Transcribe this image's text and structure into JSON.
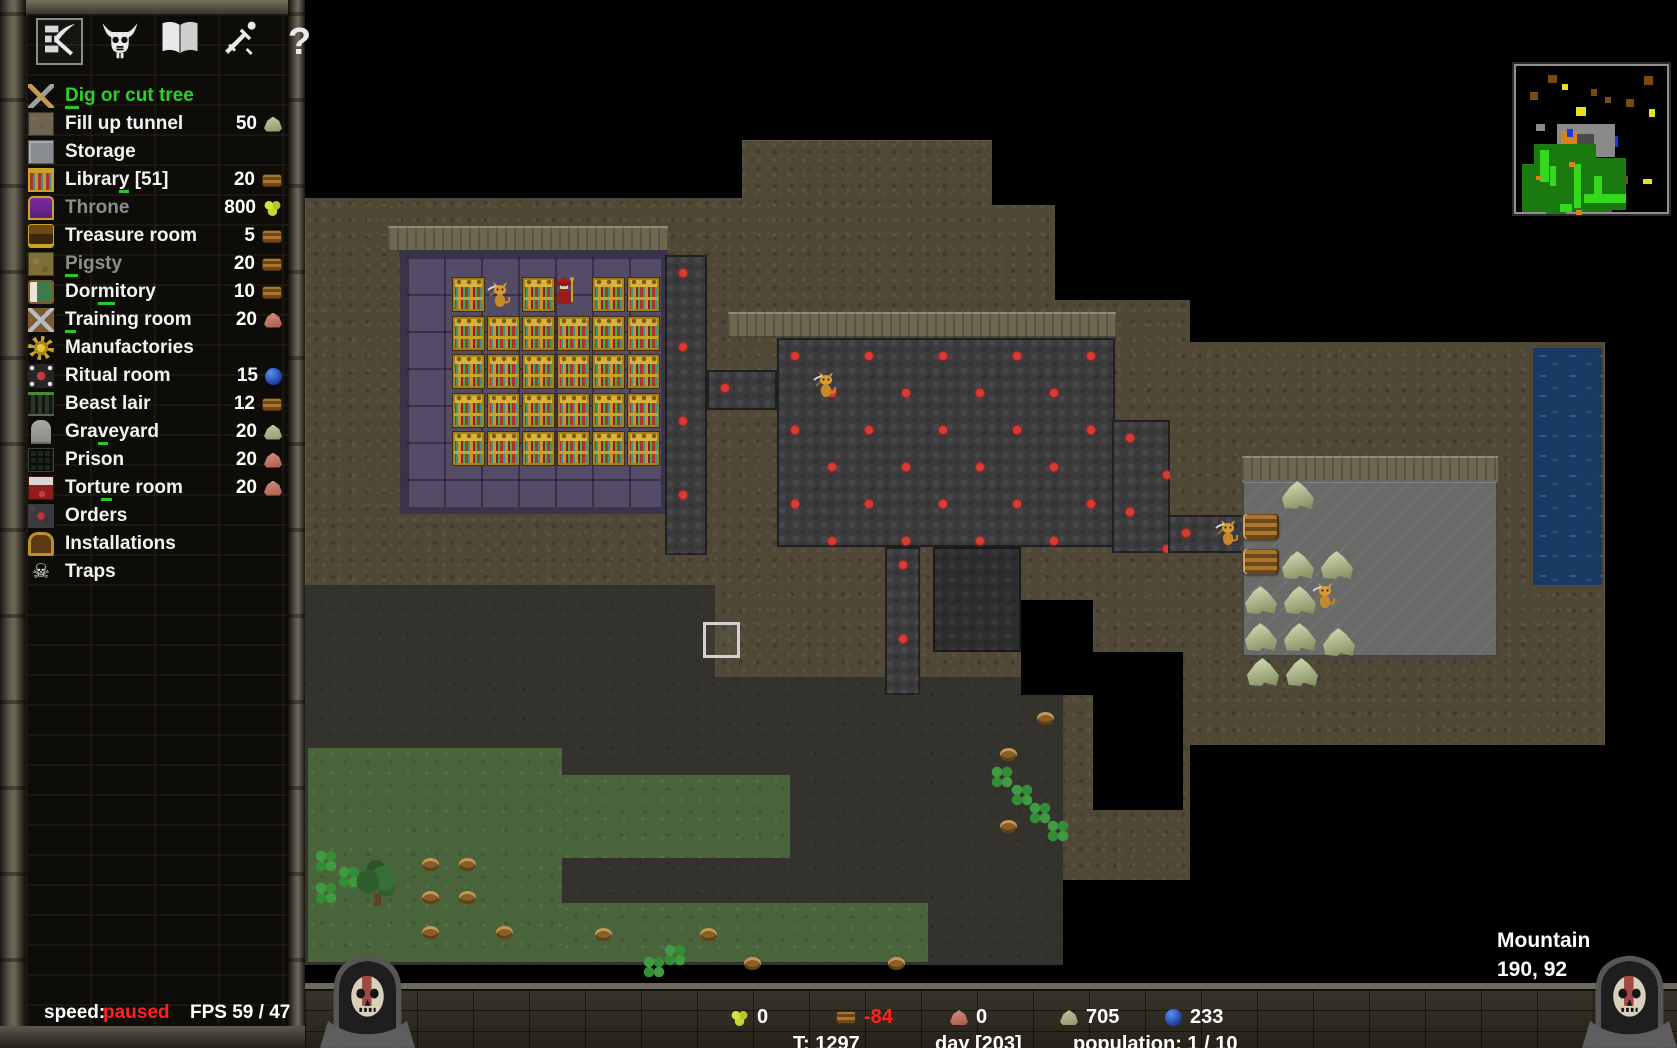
{
  "accent_colors": {
    "selected_green": "#2bd12b",
    "shortcut_green": "#28c828",
    "negative_red": "#ff2020",
    "text_white": "#ffffff",
    "disabled_grey": "#8d8d8d"
  },
  "sidebar": {
    "toolbar": [
      {
        "id": "build",
        "icon": "pickaxe-wall-icon",
        "selected": true
      },
      {
        "id": "minions",
        "icon": "demon-skull-icon",
        "selected": false
      },
      {
        "id": "library",
        "icon": "open-book-icon",
        "selected": false
      },
      {
        "id": "military",
        "icon": "sword-icon",
        "selected": false
      },
      {
        "id": "help",
        "icon": "question-mark-icon",
        "selected": false,
        "glyph": "?"
      }
    ],
    "menu": [
      {
        "label": "Dig or cut tree",
        "shortcut_index": 0,
        "icon": "dig",
        "state": "selected"
      },
      {
        "label": "Fill up tunnel",
        "icon": "fill",
        "state": "normal",
        "cost": "50",
        "cost_resource": "stone"
      },
      {
        "label": "Storage",
        "icon": "storage",
        "state": "normal"
      },
      {
        "label": "Library [51]",
        "shortcut_index": 6,
        "icon": "library",
        "state": "normal",
        "cost": "20",
        "cost_resource": "wood"
      },
      {
        "label": "Throne",
        "icon": "throne",
        "state": "disabled",
        "cost": "800",
        "cost_resource": "gold"
      },
      {
        "label": "Treasure room",
        "icon": "treasure",
        "state": "normal",
        "cost": "5",
        "cost_resource": "wood"
      },
      {
        "label": "Pigsty",
        "shortcut_index": 0,
        "icon": "pigsty",
        "state": "disabled",
        "cost": "20",
        "cost_resource": "wood"
      },
      {
        "label": "Dormitory",
        "shortcut_index": 3,
        "icon": "dormitory",
        "state": "normal",
        "cost": "10",
        "cost_resource": "wood"
      },
      {
        "label": "Training room",
        "shortcut_index": 0,
        "icon": "training",
        "state": "normal",
        "cost": "20",
        "cost_resource": "iron"
      },
      {
        "label": "Manufactories",
        "icon": "manufactory",
        "state": "normal"
      },
      {
        "label": "Ritual room",
        "icon": "ritual",
        "state": "normal",
        "cost": "15",
        "cost_resource": "mana"
      },
      {
        "label": "Beast lair",
        "icon": "beast",
        "state": "normal",
        "cost": "12",
        "cost_resource": "wood"
      },
      {
        "label": "Graveyard",
        "shortcut_index": 3,
        "icon": "graveyard",
        "state": "normal",
        "cost": "20",
        "cost_resource": "stone"
      },
      {
        "label": "Prison",
        "icon": "prison",
        "state": "normal",
        "cost": "20",
        "cost_resource": "iron"
      },
      {
        "label": "Torture room",
        "shortcut_index": 4,
        "icon": "torture",
        "state": "normal",
        "cost": "20",
        "cost_resource": "iron"
      },
      {
        "label": "Orders",
        "icon": "orders",
        "state": "normal"
      },
      {
        "label": "Installations",
        "icon": "installations",
        "state": "normal"
      },
      {
        "label": "Traps",
        "icon": "traps",
        "state": "normal",
        "icon_glyph": "☠"
      }
    ],
    "speed_label": "speed:",
    "speed_value": "paused",
    "fps": "FPS 59 / 47"
  },
  "map": {
    "location_label": "Mountain",
    "coordinates": "190, 92",
    "regions": [
      [
        305,
        0,
        1372,
        985,
        "black"
      ],
      [
        305,
        140,
        1300,
        825,
        "rock"
      ],
      [
        305,
        140,
        437,
        58,
        "black"
      ],
      [
        992,
        140,
        685,
        65,
        "black"
      ],
      [
        1055,
        205,
        622,
        95,
        "black"
      ],
      [
        1190,
        300,
        487,
        42,
        "black"
      ],
      [
        1605,
        140,
        72,
        825,
        "black"
      ],
      [
        1093,
        652,
        90,
        158,
        "black"
      ],
      [
        1063,
        880,
        542,
        85,
        "black"
      ],
      [
        1190,
        745,
        415,
        135,
        "black"
      ],
      [
        388,
        226,
        280,
        26,
        "walltop"
      ],
      [
        728,
        312,
        388,
        26,
        "walltop"
      ],
      [
        1242,
        456,
        256,
        26,
        "walltop"
      ],
      [
        305,
        585,
        410,
        380,
        "earth"
      ],
      [
        713,
        677,
        350,
        288,
        "earth"
      ],
      [
        308,
        748,
        254,
        214,
        "grass"
      ],
      [
        562,
        775,
        228,
        83,
        "grass"
      ],
      [
        562,
        903,
        366,
        59,
        "grass"
      ],
      [
        400,
        250,
        268,
        264,
        "library"
      ],
      [
        665,
        255,
        42,
        300,
        "cobble"
      ],
      [
        707,
        370,
        70,
        40,
        "cobble"
      ],
      [
        777,
        338,
        338,
        209,
        "cobble"
      ],
      [
        885,
        547,
        35,
        148,
        "cobble"
      ],
      [
        1112,
        420,
        58,
        133,
        "cobble"
      ],
      [
        1168,
        515,
        76,
        38,
        "cobble"
      ],
      [
        933,
        547,
        88,
        105,
        "cobble_dim"
      ],
      [
        1021,
        600,
        72,
        95,
        "black"
      ],
      [
        1242,
        480,
        256,
        177,
        "storage"
      ],
      [
        1533,
        348,
        69,
        237,
        "water"
      ]
    ],
    "library_shelves": {
      "origin": [
        452,
        277
      ],
      "cols": 6,
      "rows": 5,
      "dx": 35,
      "dy": 38.5,
      "skip": [
        [
          1,
          0
        ],
        [
          3,
          0
        ]
      ]
    },
    "items": [
      {
        "type": "stone",
        "x": 1282,
        "y": 481
      },
      {
        "type": "stone",
        "x": 1282,
        "y": 551
      },
      {
        "type": "stone",
        "x": 1321,
        "y": 551
      },
      {
        "type": "stone",
        "x": 1245,
        "y": 586
      },
      {
        "type": "stone",
        "x": 1284,
        "y": 586
      },
      {
        "type": "stone",
        "x": 1245,
        "y": 623
      },
      {
        "type": "stone",
        "x": 1284,
        "y": 623
      },
      {
        "type": "stone",
        "x": 1323,
        "y": 628
      },
      {
        "type": "stone",
        "x": 1247,
        "y": 658
      },
      {
        "type": "stone",
        "x": 1286,
        "y": 658
      },
      {
        "type": "wood",
        "x": 1243,
        "y": 514
      },
      {
        "type": "wood",
        "x": 1243,
        "y": 549
      },
      {
        "type": "stump",
        "x": 422,
        "y": 858
      },
      {
        "type": "stump",
        "x": 459,
        "y": 858
      },
      {
        "type": "stump",
        "x": 422,
        "y": 891
      },
      {
        "type": "stump",
        "x": 459,
        "y": 891
      },
      {
        "type": "stump",
        "x": 422,
        "y": 926
      },
      {
        "type": "stump",
        "x": 496,
        "y": 926
      },
      {
        "type": "stump",
        "x": 595,
        "y": 928
      },
      {
        "type": "stump",
        "x": 700,
        "y": 928
      },
      {
        "type": "stump",
        "x": 744,
        "y": 957
      },
      {
        "type": "stump",
        "x": 888,
        "y": 957
      },
      {
        "type": "stump",
        "x": 1037,
        "y": 712
      },
      {
        "type": "stump",
        "x": 1000,
        "y": 748
      },
      {
        "type": "stump",
        "x": 1000,
        "y": 820
      },
      {
        "type": "clover",
        "x": 313,
        "y": 848
      },
      {
        "type": "clover",
        "x": 336,
        "y": 864
      },
      {
        "type": "clover",
        "x": 313,
        "y": 880
      },
      {
        "type": "clover",
        "x": 989,
        "y": 764
      },
      {
        "type": "clover",
        "x": 1009,
        "y": 782
      },
      {
        "type": "clover",
        "x": 1027,
        "y": 800
      },
      {
        "type": "clover",
        "x": 1045,
        "y": 818
      },
      {
        "type": "clover",
        "x": 662,
        "y": 942
      },
      {
        "type": "clover",
        "x": 641,
        "y": 954
      },
      {
        "type": "tree",
        "x": 354,
        "y": 860
      }
    ],
    "creatures": [
      {
        "type": "imp",
        "x": 486,
        "y": 280
      },
      {
        "type": "keeper",
        "x": 549,
        "y": 274
      },
      {
        "type": "imp",
        "x": 812,
        "y": 370
      },
      {
        "type": "imp",
        "x": 1214,
        "y": 518
      },
      {
        "type": "imp",
        "x": 1311,
        "y": 581
      }
    ],
    "selection": {
      "x": 703,
      "y": 622,
      "w": 37,
      "h": 36
    }
  },
  "minimap": {
    "palette": {
      "brown": "#7a4a12",
      "yellow": "#e8e214",
      "grey": "#8a8a8a",
      "darkgrey": "#4a4a4a",
      "orange": "#d9821a",
      "blue": "#2038d8",
      "green": "#1a7a10",
      "lightgreen": "#35d81c"
    },
    "blobs": [
      [
        32,
        9,
        9,
        8,
        "brown"
      ],
      [
        14,
        26,
        8,
        8,
        "brown"
      ],
      [
        75,
        23,
        6,
        7,
        "brown"
      ],
      [
        89,
        31,
        6,
        6,
        "brown"
      ],
      [
        110,
        33,
        8,
        8,
        "brown"
      ],
      [
        128,
        10,
        9,
        9,
        "brown"
      ],
      [
        105,
        110,
        7,
        8,
        "brown"
      ],
      [
        46,
        18,
        6,
        6,
        "yellow"
      ],
      [
        60,
        41,
        10,
        9,
        "yellow"
      ],
      [
        133,
        43,
        6,
        8,
        "yellow"
      ],
      [
        127,
        113,
        9,
        5,
        "yellow"
      ],
      [
        82,
        75,
        14,
        11,
        "yellow"
      ],
      [
        20,
        58,
        9,
        7,
        "grey"
      ],
      [
        41,
        58,
        58,
        33,
        "grey"
      ],
      [
        60,
        68,
        18,
        13,
        "darkgrey"
      ],
      [
        45,
        65,
        16,
        15,
        "orange"
      ],
      [
        51,
        63,
        6,
        8,
        "blue"
      ],
      [
        99,
        70,
        3,
        11,
        "blue"
      ],
      [
        18,
        78,
        62,
        42,
        "green"
      ],
      [
        6,
        98,
        64,
        48,
        "green"
      ],
      [
        38,
        118,
        58,
        28,
        "green"
      ],
      [
        62,
        92,
        48,
        52,
        "green"
      ],
      [
        30,
        140,
        20,
        8,
        "green"
      ],
      [
        24,
        84,
        9,
        32,
        "lightgreen"
      ],
      [
        58,
        98,
        7,
        44,
        "lightgreen"
      ],
      [
        68,
        128,
        42,
        9,
        "lightgreen"
      ],
      [
        44,
        138,
        12,
        8,
        "lightgreen"
      ],
      [
        34,
        100,
        6,
        20,
        "lightgreen"
      ],
      [
        78,
        110,
        8,
        26,
        "lightgreen"
      ],
      [
        53,
        96,
        6,
        5,
        "orange"
      ],
      [
        60,
        144,
        6,
        5,
        "orange"
      ],
      [
        20,
        110,
        5,
        4,
        "orange"
      ]
    ]
  },
  "bottom_bar": {
    "resources": [
      {
        "name": "gold",
        "value": "0",
        "value_color": "#ffffff"
      },
      {
        "name": "wood",
        "value": "-84",
        "value_color": "#ff2020"
      },
      {
        "name": "iron",
        "value": "0",
        "value_color": "#ffffff"
      },
      {
        "name": "stone",
        "value": "705",
        "value_color": "#ffffff"
      },
      {
        "name": "mana",
        "value": "233",
        "value_color": "#ffffff"
      }
    ],
    "info": [
      "T: 1297",
      "day [203]",
      "population: 1 / 10"
    ]
  }
}
